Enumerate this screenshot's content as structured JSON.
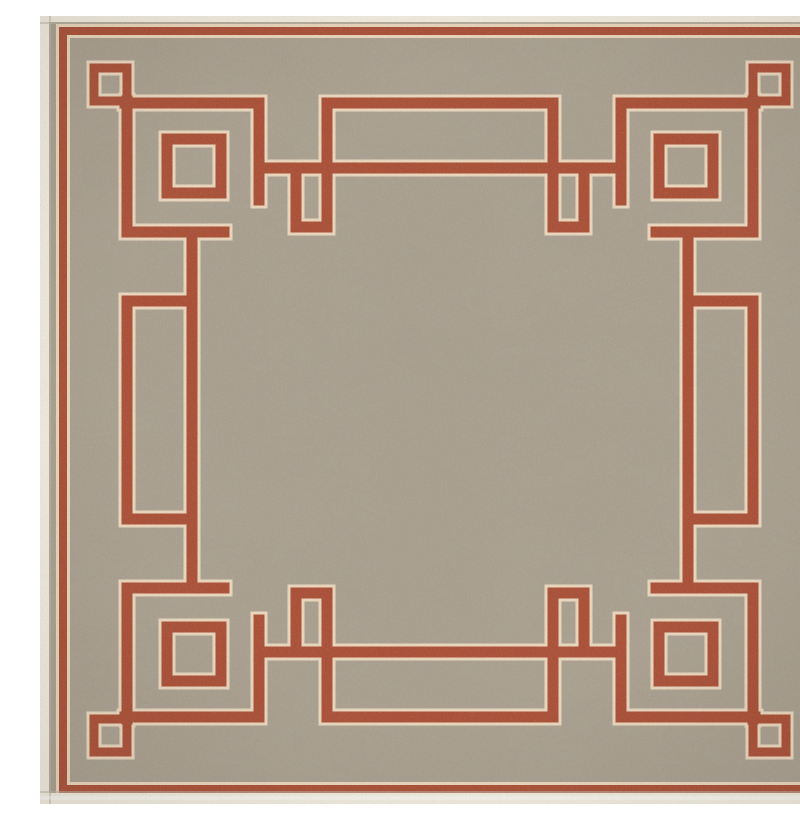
{
  "image": {
    "type": "product-photo",
    "subject": "square flat-weave area rug seen from directly above",
    "alt": "Top-down photo of a square taupe flat-weave rug with a rust-red Greek-key fret border: a thin red line near the edge, small outlined squares in each corner, larger outlined squares set diagonally inward, interlocking red lines edged in cream, rectangular key tabs at the middle of each side, and an open taupe center field. The rug has a cream binding along its edges."
  },
  "palette": {
    "field": "#a89e8d",
    "accent_red": "#a94a30",
    "cream_outline": "#ecd7bc",
    "binding": "#f3eee0",
    "edge_shadow": "#bdb6a5",
    "vignette": "#32281e"
  },
  "pattern": {
    "name": "greek-key-fret-border",
    "ground": "heathered taupe",
    "line_style": "rust-red bands edged in cream",
    "corner_small_squares": 4,
    "corner_large_squares": 4,
    "side_key_tabs": 4,
    "outer_border_lines": 1,
    "center": "open field"
  }
}
